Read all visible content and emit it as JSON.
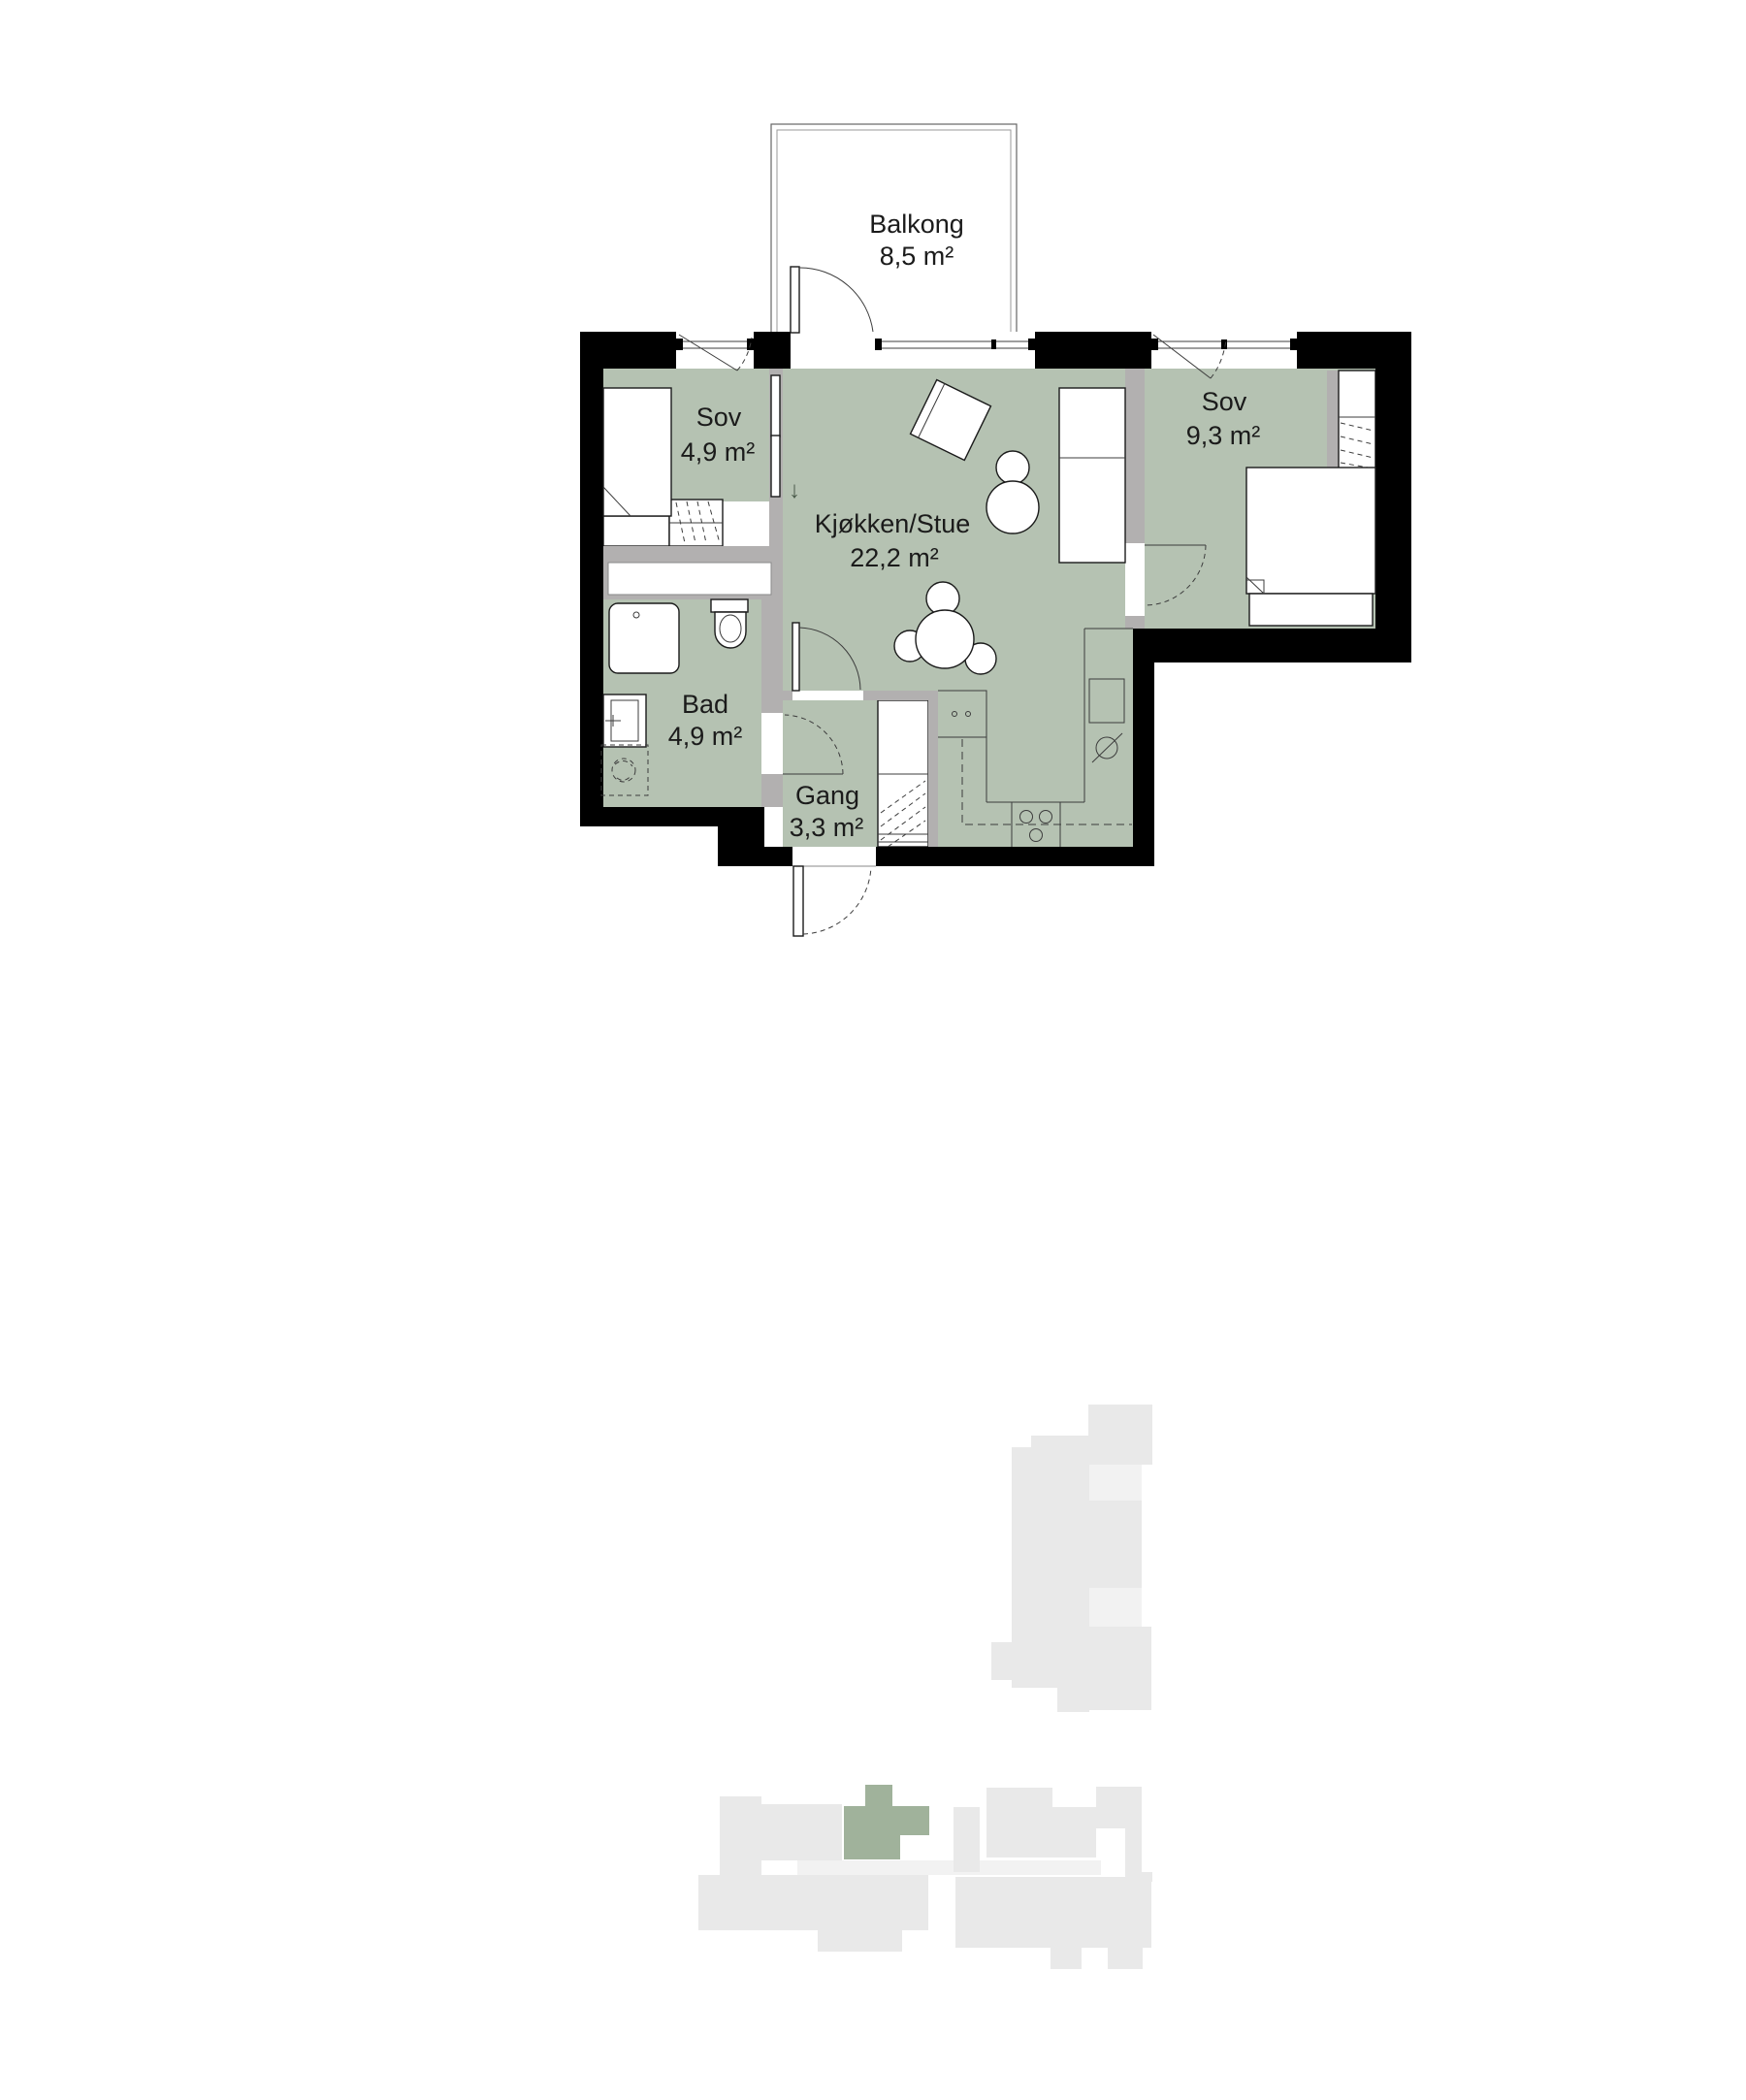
{
  "colors": {
    "room_fill": "#b5c2b2",
    "wall_black": "#000000",
    "wall_gray": "#b2b0b0",
    "site_gray": "#e9e9e9",
    "site_gray_light": "#f2f2f2",
    "site_green": "#a0b29b",
    "ink": "#1b1b1b"
  },
  "floor_plan": {
    "rooms": [
      {
        "id": "balcony",
        "name": "Balkong",
        "area": "8,5 m²"
      },
      {
        "id": "bedroom-small",
        "name": "Sov",
        "area": "4,9 m²"
      },
      {
        "id": "kitchen-living",
        "name": "Kjøkken/Stue",
        "area": "22,2 m²"
      },
      {
        "id": "bedroom-large",
        "name": "Sov",
        "area": "9,3 m²"
      },
      {
        "id": "bathroom",
        "name": "Bad",
        "area": "4,9 m²"
      },
      {
        "id": "hallway",
        "name": "Gang",
        "area": "3,3 m²"
      }
    ],
    "symbols": {
      "entry_arrow": "↓"
    }
  }
}
